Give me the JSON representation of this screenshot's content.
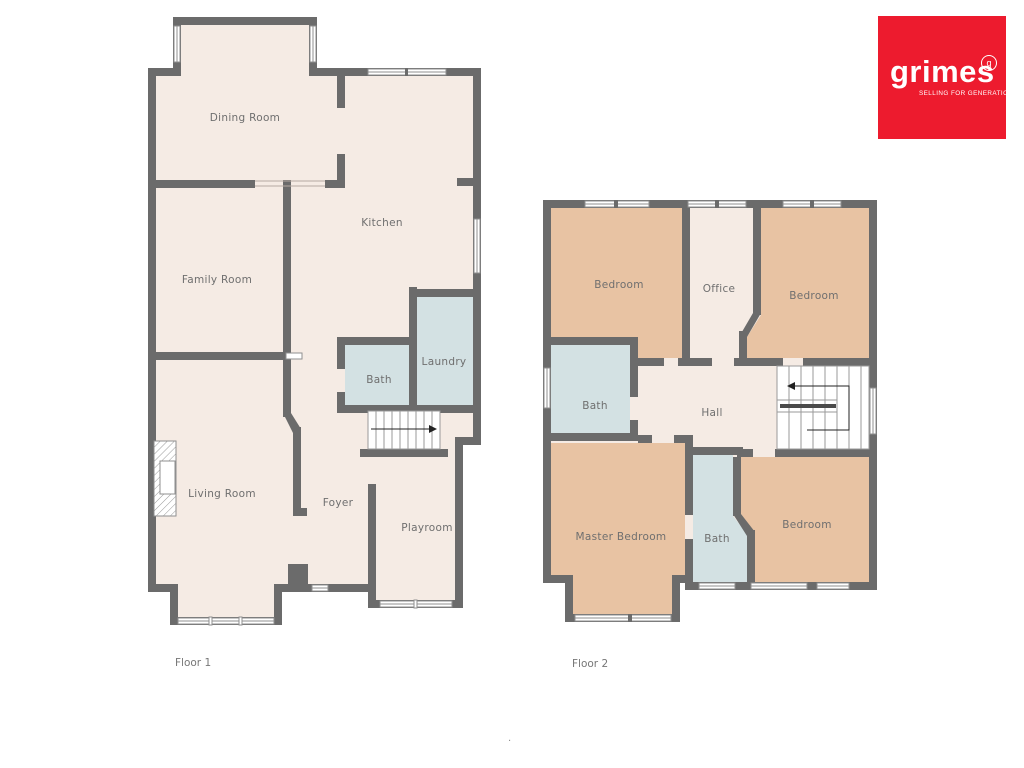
{
  "logo": {
    "brand": "grimes",
    "mark": "g",
    "tagline": "SELLING FOR GENERATIONS",
    "bg_color": "#ed1b2e",
    "text_color": "#ffffff"
  },
  "colors": {
    "wall": "#6b6b6b",
    "floor": "#f5ebe4",
    "bedroom_fill": "#e8c3a3",
    "bath_fill": "#d3e1e3",
    "stairs_fill": "#ffffff",
    "label_text": "#6f6f6f"
  },
  "floor1": {
    "caption": "Floor 1",
    "rooms": [
      {
        "name": "Dining Room"
      },
      {
        "name": "Kitchen"
      },
      {
        "name": "Family Room"
      },
      {
        "name": "Laundry"
      },
      {
        "name": "Bath"
      },
      {
        "name": "Living Room"
      },
      {
        "name": "Foyer"
      },
      {
        "name": "Playroom"
      }
    ]
  },
  "floor2": {
    "caption": "Floor 2",
    "rooms": [
      {
        "name": "Bedroom"
      },
      {
        "name": "Office"
      },
      {
        "name": "Bedroom"
      },
      {
        "name": "Bath"
      },
      {
        "name": "Hall"
      },
      {
        "name": "Master Bedroom"
      },
      {
        "name": "Bath"
      },
      {
        "name": "Bedroom"
      }
    ]
  },
  "footer": {
    "dot": "."
  }
}
